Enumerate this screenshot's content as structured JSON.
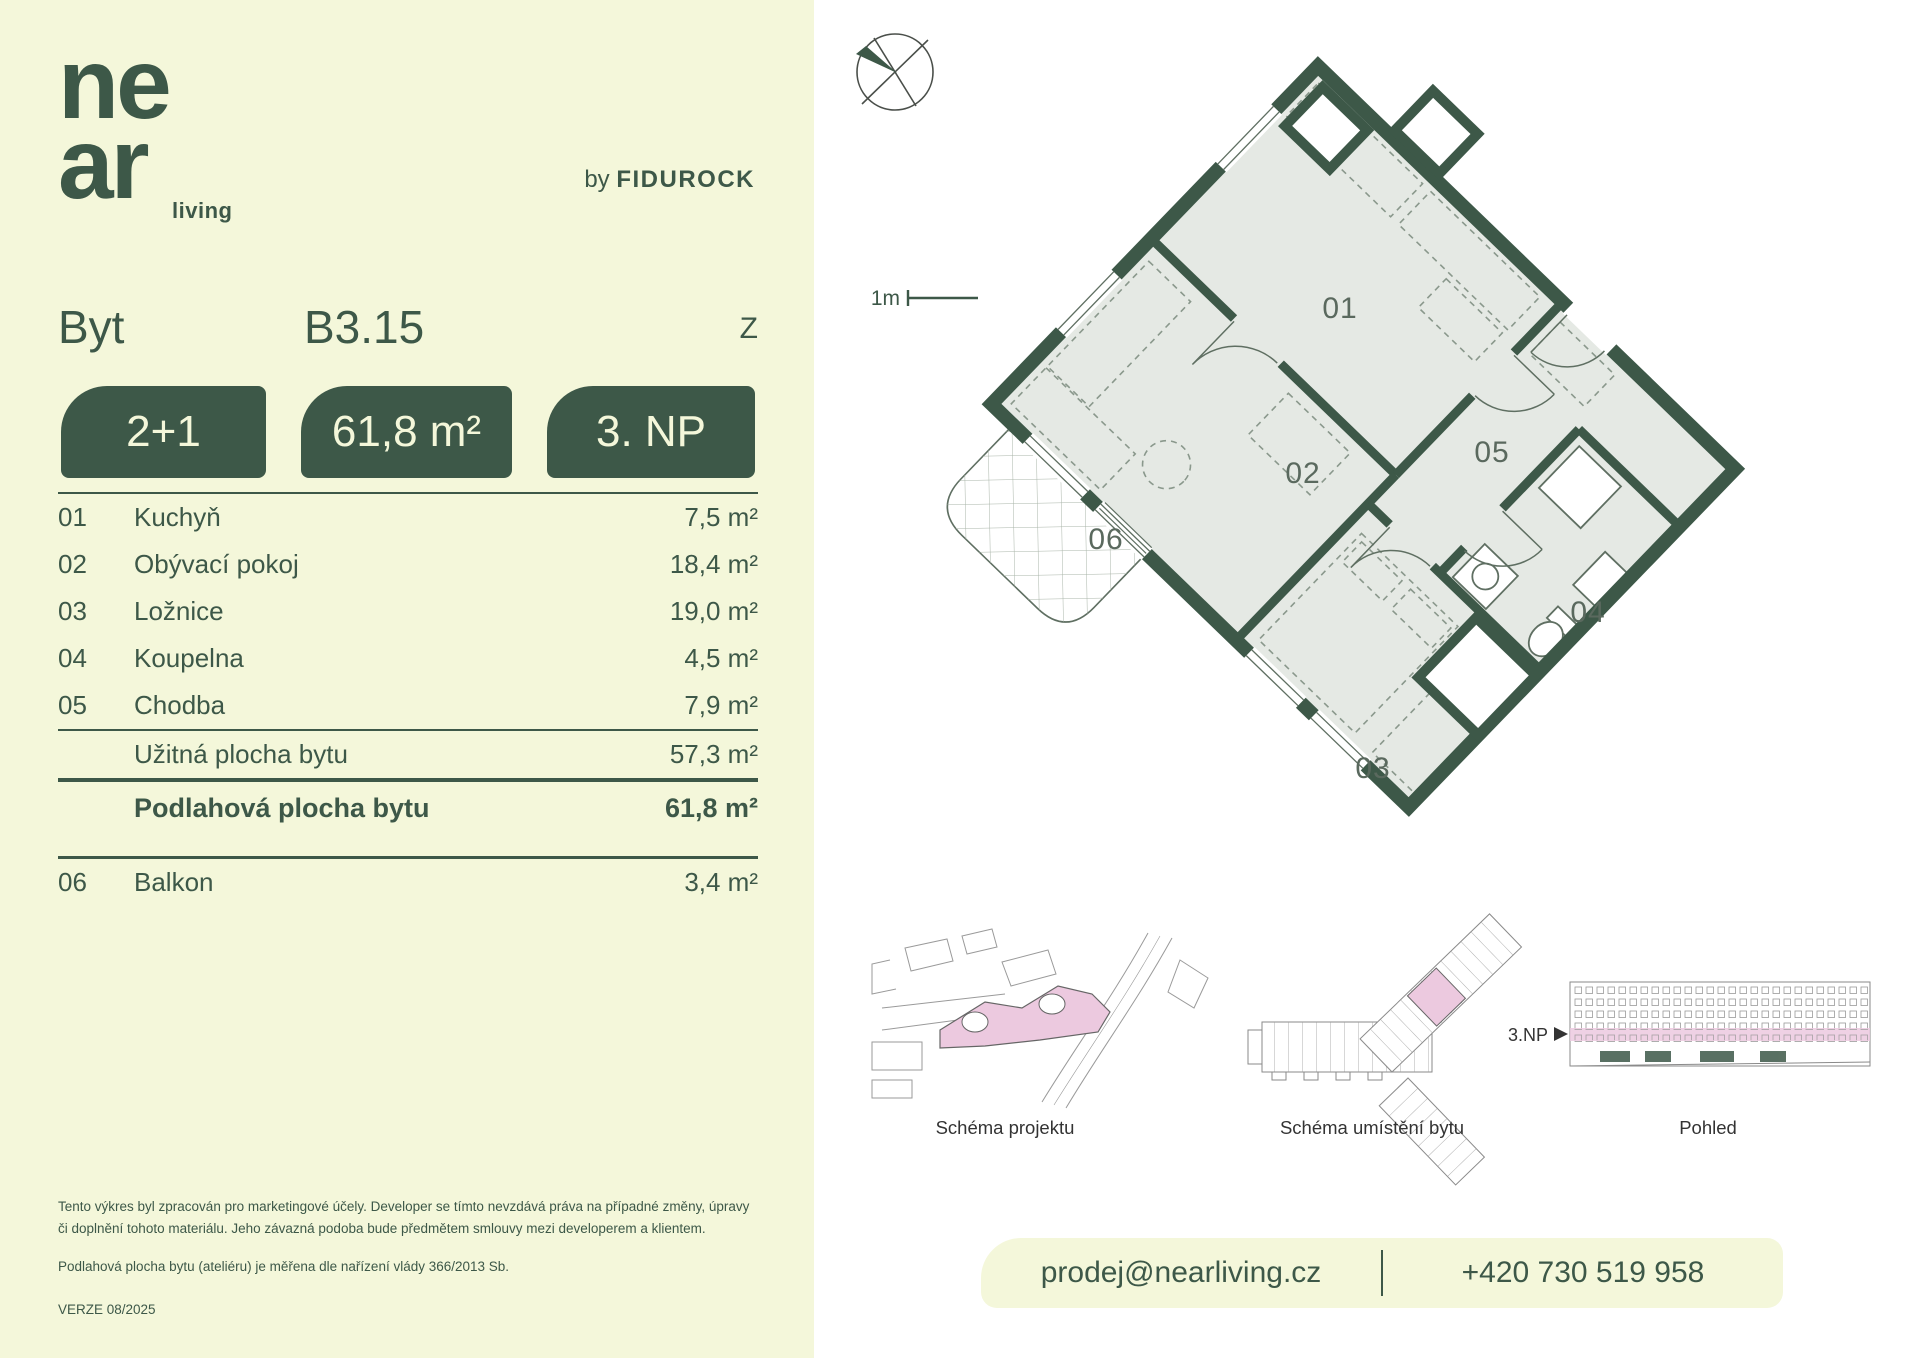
{
  "brand": {
    "logo_top": "ne",
    "logo_bottom": "ar",
    "logo_sub": "living",
    "by_prefix": "by ",
    "by_name": "FIDUROCK"
  },
  "header": {
    "type_label": "Byt",
    "unit_code": "B3.15",
    "orientation": "Z"
  },
  "badges": {
    "layout": "2+1",
    "area": "61,8 m²",
    "floor": "3. NP"
  },
  "room_table": {
    "rows": [
      {
        "num": "01",
        "name": "Kuchyň",
        "area": "7,5 m²"
      },
      {
        "num": "02",
        "name": "Obývací pokoj",
        "area": "18,4 m²"
      },
      {
        "num": "03",
        "name": "Ložnice",
        "area": "19,0 m²"
      },
      {
        "num": "04",
        "name": "Koupelna",
        "area": "4,5 m²"
      },
      {
        "num": "05",
        "name": "Chodba",
        "area": "7,9 m²"
      }
    ],
    "usable": {
      "label": "Užitná plocha bytu",
      "value": "57,3 m²"
    },
    "total": {
      "label": "Podlahová plocha bytu",
      "value": "61,8 m²"
    },
    "balcony": {
      "num": "06",
      "name": "Balkon",
      "area": "3,4 m²"
    }
  },
  "plan": {
    "scale_label": "1m",
    "labels": {
      "r01": "01",
      "r02": "02",
      "r03": "03",
      "r04": "04",
      "r05": "05",
      "r06": "06"
    }
  },
  "schematics": {
    "project_caption": "Schéma projektu",
    "unit_caption": "Schéma umístění bytu",
    "elevation_caption": "Pohled",
    "floor_marker": "3.NP"
  },
  "footnotes": {
    "disclaimer": "Tento výkres byl zpracován pro marketingové účely. Developer se tímto nevzdává práva na případné změny, úpravy či doplnění tohoto materiálu. Jeho závazná podoba bude předmětem smlouvy mezi developerem a klientem.",
    "measurement": "Podlahová plocha bytu (ateliéru) je měřena dle nařízení vlády 366/2013 Sb.",
    "version": "VERZE 08/2025"
  },
  "contact": {
    "email": "prodej@nearliving.cz",
    "phone": "+420 730 519 958"
  },
  "colors": {
    "accent_green": "#3d5848",
    "panel_bg": "#f4f7da",
    "highlight_pink": "#ecc9df",
    "plan_floor": "#e5e9e4"
  }
}
